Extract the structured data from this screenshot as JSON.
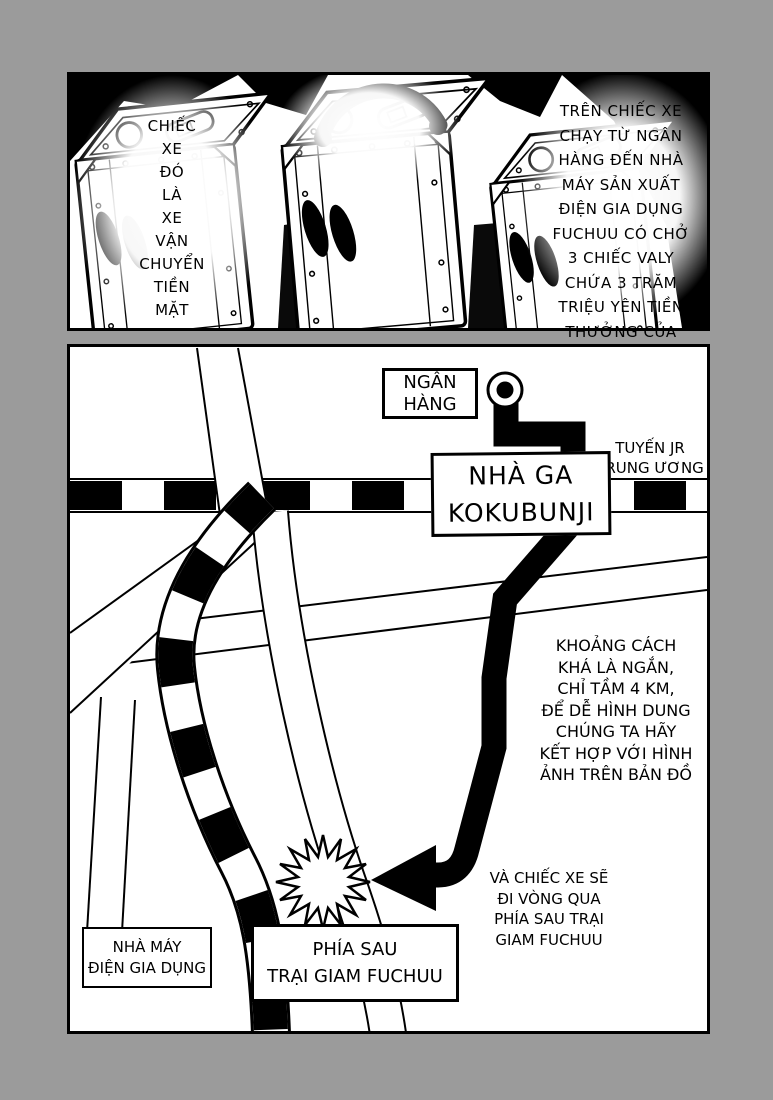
{
  "page": {
    "bg_color": "#9b9b9b",
    "paper_color": "#ffffff",
    "ink_color": "#000000"
  },
  "top_panel": {
    "caption_left": "CHIẾC\nXE\nĐÓ\nLÀ\nXE\nVẬN\nCHUYỂN\nTIỀN\nMẶT",
    "caption_right": "TRÊN CHIẾC XE\nCHẠY TỪ NGÂN\nHÀNG ĐẾN NHÀ\nMÁY SẢN XUẤT\nĐIỆN GIA DỤNG\nFUCHUU CÓ CHỞ\n3 CHIẾC VALY\nCHỨA 3 TRĂM\nTRIỆU YÊN TIỀN\nTHƯỞNG CỦA\nCÔNG NHÂN"
  },
  "map_panel": {
    "bank_label": "NGÂN\nHÀNG",
    "rail_line_label": "TUYẾN JR\nTRUNG ƯƠNG",
    "station_label": "NHÀ GA\nKOKUBUNJI",
    "distance_note": "KHOẢNG CÁCH\nKHÁ LÀ NGẮN,\nCHỈ TẦM 4 KM,\nĐỂ DỄ HÌNH DUNG\nCHÚNG TA HÃY\nKẾT HỢP VỚI HÌNH\nẢNH TRÊN BẢN ĐỒ",
    "route_note": "VÀ CHIẾC XE SẼ\nĐI VÒNG QUA\nPHÍA SAU TRẠI\nGIAM FUCHUU",
    "factory_label": "NHÀ MÁY\nĐIỆN GIA DỤNG",
    "destination_label": "PHÍA SAU\nTRẠI GIAM FUCHUU"
  }
}
